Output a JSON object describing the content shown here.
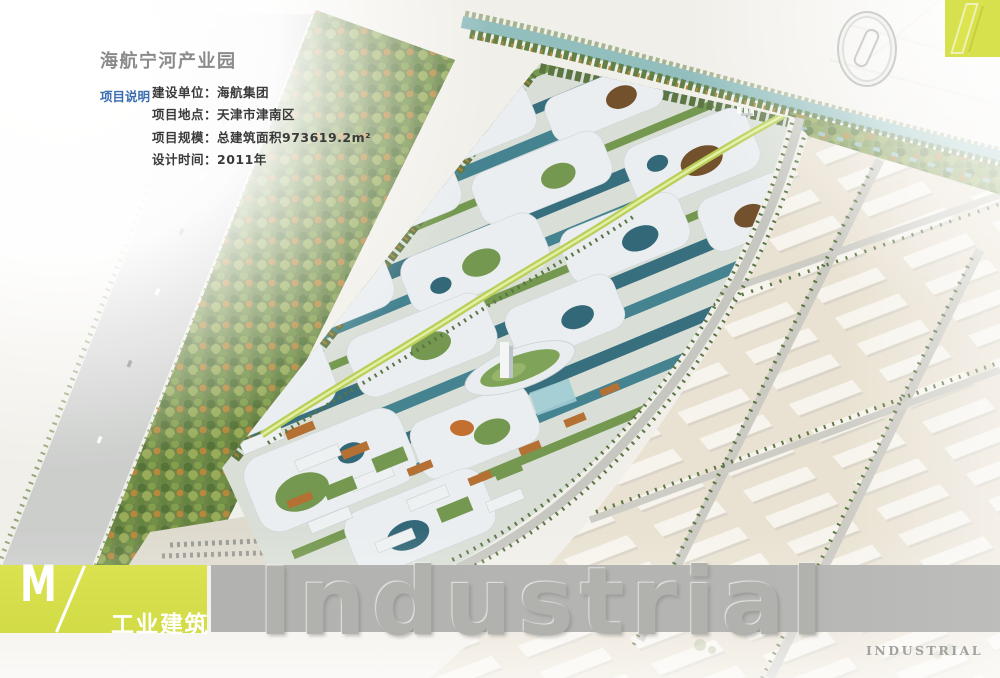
{
  "header": {
    "title": "海航宁河产业园",
    "page_number": "01"
  },
  "project_info": {
    "section_label": "项目说明",
    "rows": [
      "建设单位：海航集团",
      "项目地点：天津市津南区",
      "项目规模：总建筑面积973619.2m²",
      "设计时间：2011年"
    ]
  },
  "footer": {
    "category_code": "M",
    "category_slash": "/",
    "category_cn": "工业建筑",
    "watermark": "Industrial",
    "brand_label": "INDUSTRIAL"
  },
  "scene": {
    "alt": "海航宁河产业园鸟瞰效果图：白色曲面屋盖产业组团、滨河绿带与右侧物流仓储区"
  },
  "colors": {
    "accent_yellow": "#d7e04d",
    "band_gray": "#b4b4b2",
    "label_blue": "#3a6cb0",
    "title_gray": "#8b8b8b"
  }
}
